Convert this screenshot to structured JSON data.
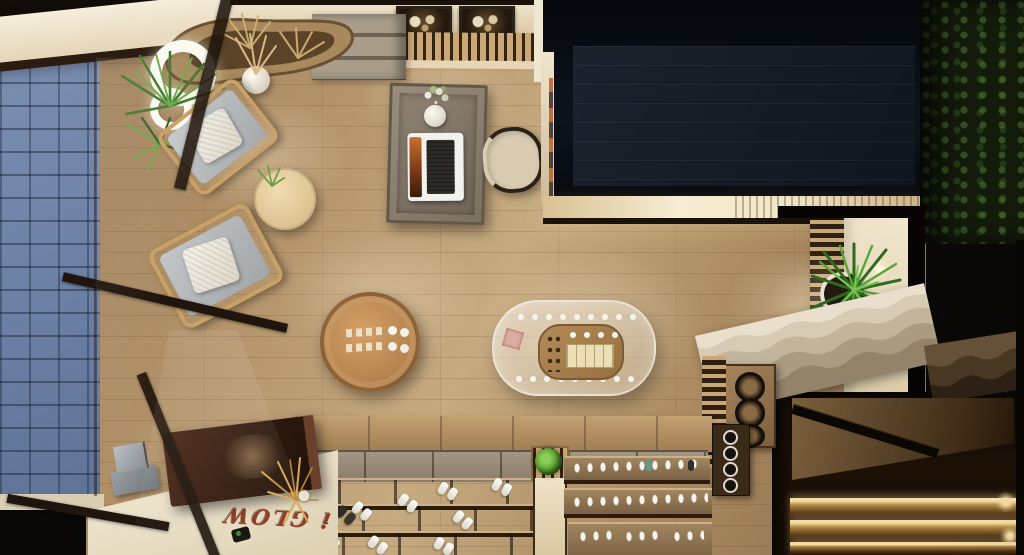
{
  "title": "Top-view 3D render of a retail store interior",
  "floor_text": "i GLOW",
  "scene_labels": {
    "walkway": "blue paver sidewalk",
    "storefront": "glass storefront with dark mullions",
    "lounge": "lounge chairs with grey cushions and white pillows",
    "side_table": "round light-wood side table",
    "counter": "curved organic reception counter with dried pampas",
    "pendants": "white ring pendant lights",
    "desk": "grey wood desk with laptop and flower vase",
    "desk_chair": "curved cream chair",
    "artworks": "two dark framed floral artworks",
    "void": "dark double-height void opening",
    "plant_wall": "dark green plant wall",
    "palm": "indoor palm plant in round pot",
    "stone_steps": "travertine steps with wavy edges",
    "round_display": "round rattan display table with products",
    "oval_display": "oval glass display case with eyewear products",
    "shelves": "tiered footwear display shelves",
    "reception_desk": "dark brown reception desk with golden dried plant",
    "stairwell": "lower stairwell with LED-lit steps"
  },
  "colors": {
    "paverBlue": "#7186aa",
    "woodFloor": "#b6956e",
    "creamWall": "#eee3ca",
    "voidNavy": "#0c1119",
    "greenWall": "#141d0c",
    "leafGreen": "#4e8c33",
    "deskBrown": "#3a2014",
    "cushionGrey": "#b7babc",
    "stairGlow": "#eccf97",
    "floorText": "#8a3a20"
  }
}
